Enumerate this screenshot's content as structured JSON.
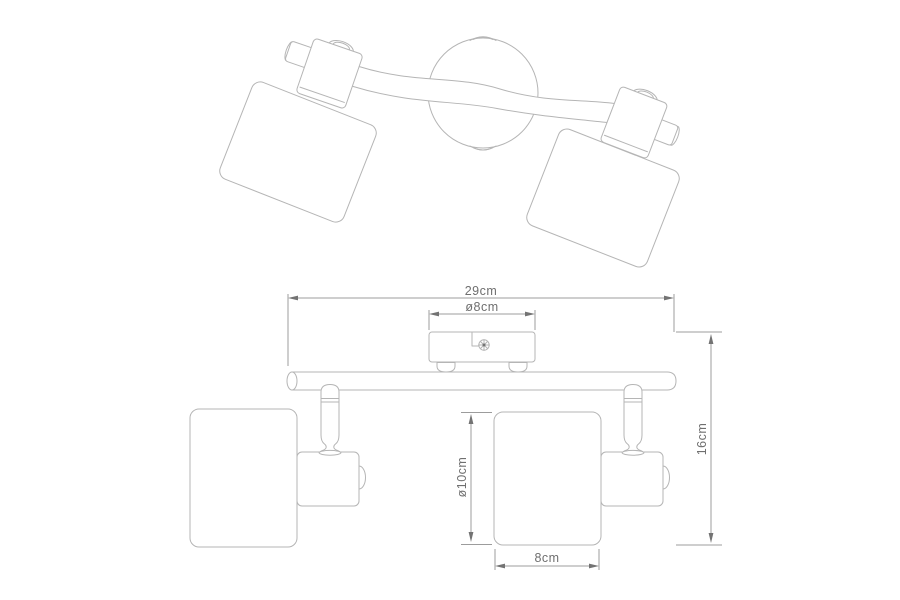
{
  "dimensions": {
    "total_width": "29cm",
    "canopy_diameter": "ø8cm",
    "total_height": "16cm",
    "shade_diameter": "ø10cm",
    "shade_width": "8cm"
  },
  "colors": {
    "background": "#ffffff",
    "line": "#b5b5b5",
    "dimension_line": "#9c9c9c",
    "arrow": "#737373",
    "text": "#6f6f6f"
  }
}
